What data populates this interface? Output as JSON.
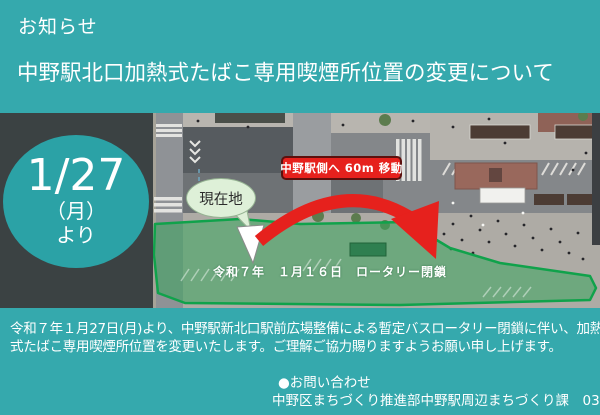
{
  "theme": {
    "background_teal": "#35a9ad",
    "panel_dark": "#3b4243",
    "badge_teal": "#2ba2a6",
    "alert_red": "#e6211d",
    "overlay_green": "#3aa55f",
    "overlay_green_border": "#10a24b",
    "bubble_green": "#def0d8",
    "text_white": "#ffffff"
  },
  "header": {
    "kicker": "お知らせ",
    "title": "中野駅北口加熱式たばこ専用喫煙所位置の変更について"
  },
  "date_badge": {
    "date": "1/27",
    "weekday": "（月）",
    "suffix": "より"
  },
  "map": {
    "type": "aerial-photo",
    "current_location_label": "現在地",
    "move_banner": "中野駅側へ 60m 移動",
    "closure_label": "令和７年　１月１６日　ロータリー閉鎖"
  },
  "body": {
    "lines": [
      "令和７年１月27日(月)より、中野駅新北口駅前広場整備による暫定バスロータリー閉鎖に伴い、加熱",
      "式たばこ専用喫煙所位置を変更いたします。ご理解ご協力賜りますようお願い申し上げます。"
    ]
  },
  "contact": {
    "heading": "●お問い合わせ",
    "line": "中野区まちづくり推進部中野駅周辺まちづくり課　03-3228-8980"
  }
}
